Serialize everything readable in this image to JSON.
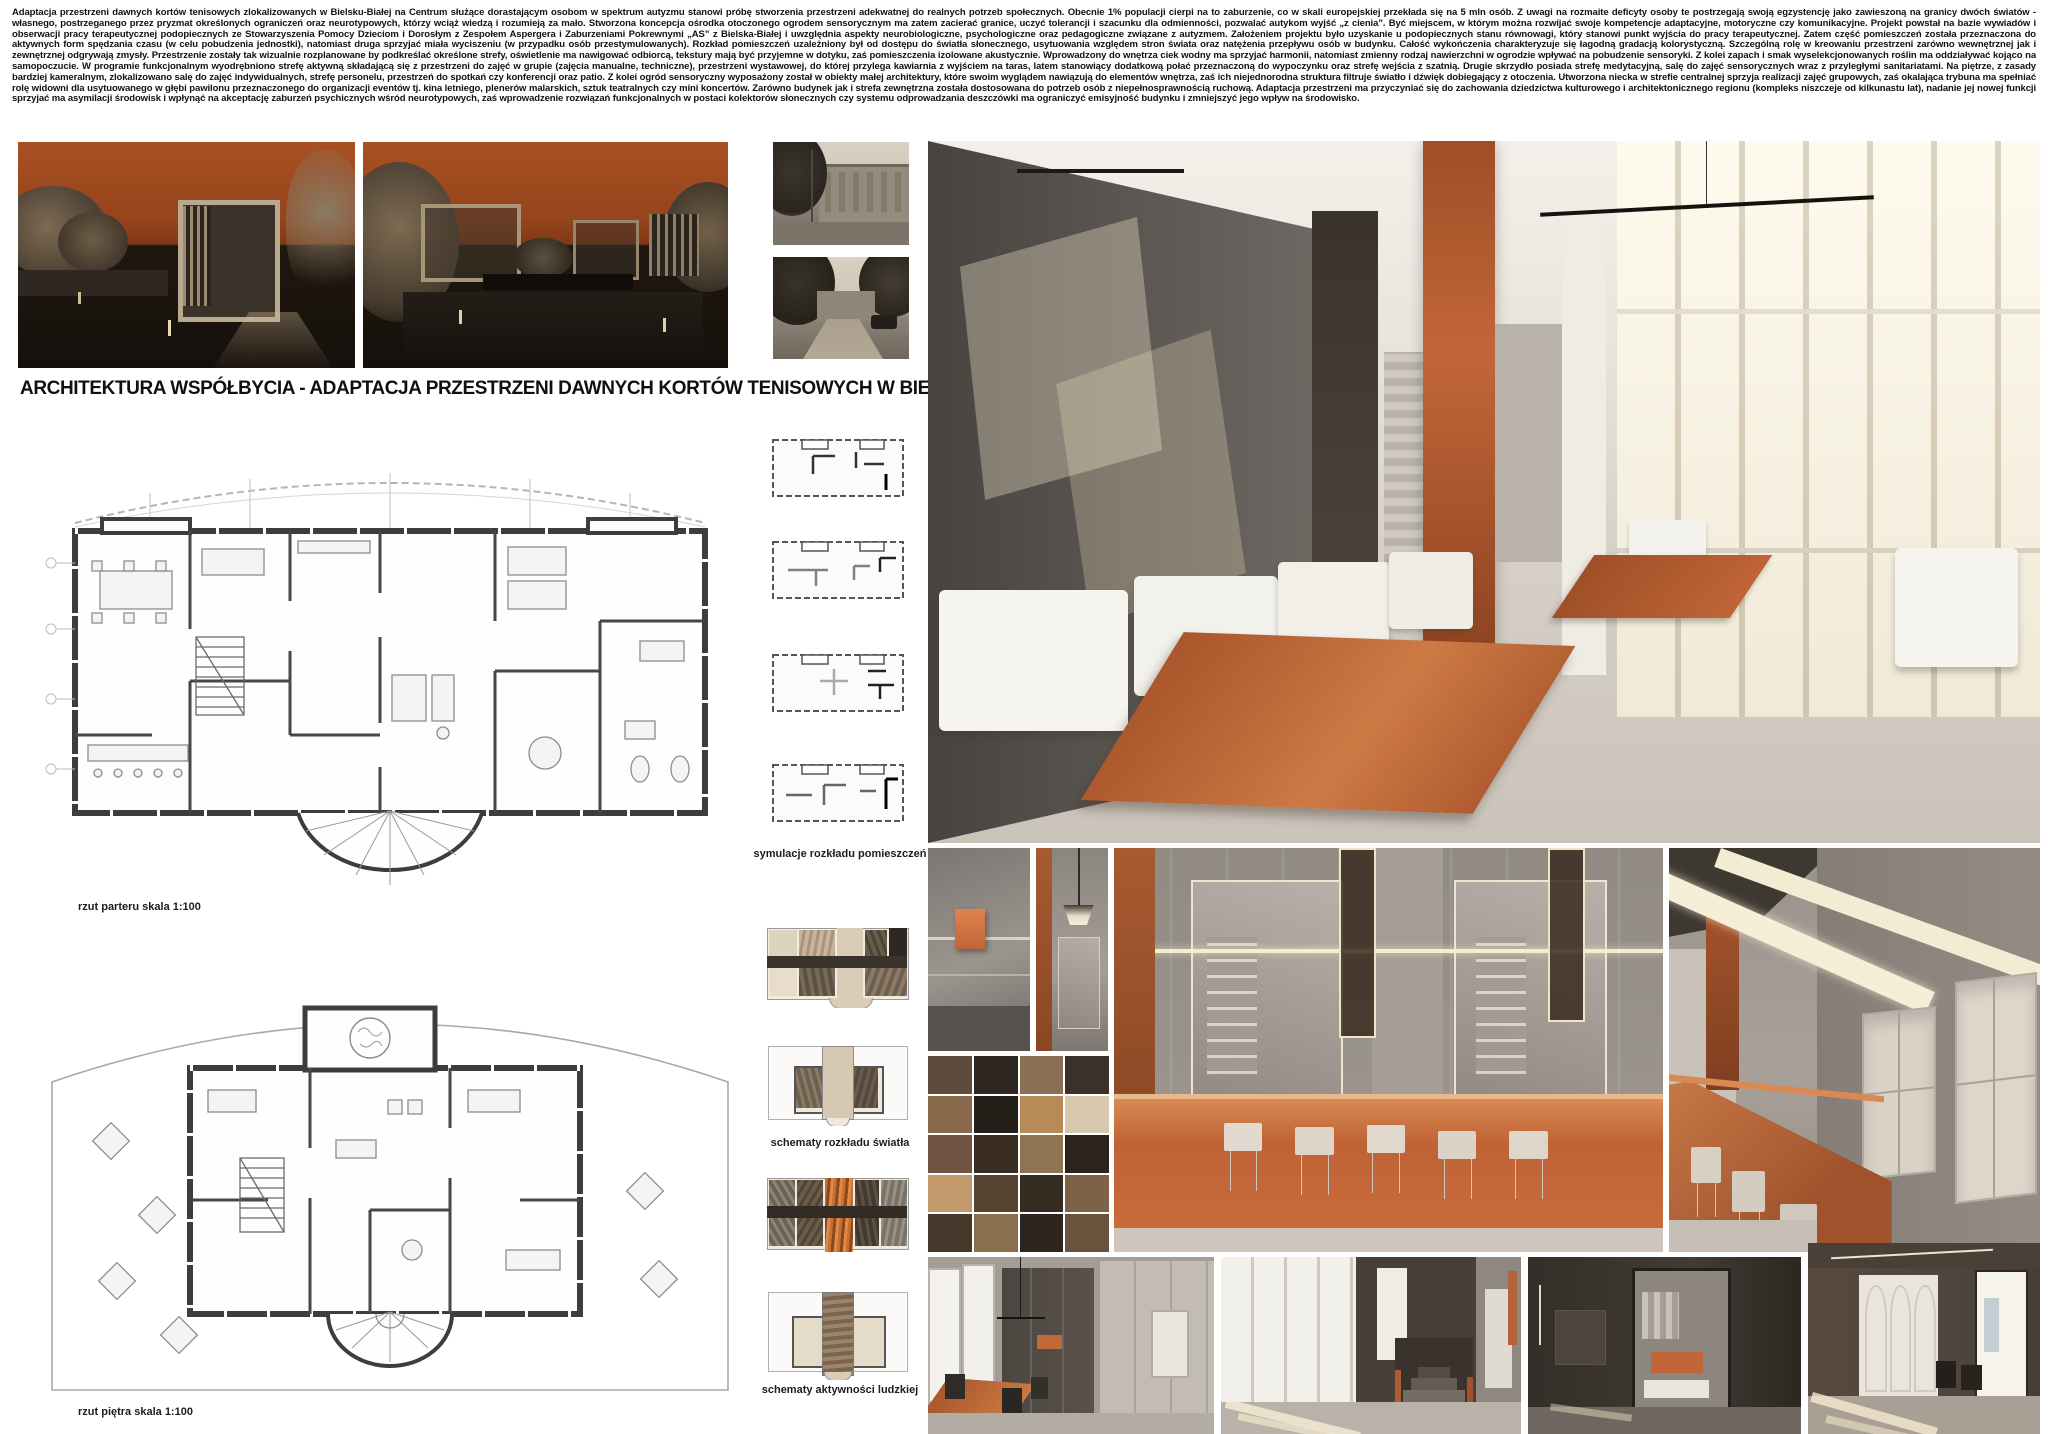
{
  "header": {
    "intro": "Adaptacja przestrzeni dawnych kortów tenisowych zlokalizowanych w Bielsku-Białej na Centrum służące dorastającym osobom w spektrum autyzmu stanowi próbę stworzenia przestrzeni adekwatnej do realnych potrzeb społecznych. Obecnie 1% populacji cierpi na to zaburzenie, co w skali europejskiej przekłada się na 5 mln osób. Z uwagi na rozmaite deficyty osoby te postrzegają swoją egzystencję jako zawieszoną na granicy dwóch światów - własnego, postrzeganego przez pryzmat określonych ograniczeń oraz neurotypowych, którzy wciąż wiedzą i rozumieją za mało. Stworzona koncepcja ośrodka otoczonego ogrodem sensorycznym ma zatem zacierać granice, uczyć tolerancji i szacunku dla odmienności, pozwalać autykom wyjść „z cienia”. Być miejscem, w którym można rozwijać swoje kompetencje adaptacyjne, motoryczne czy komunikacyjne. Projekt powstał na bazie wywiadów i obserwacji pracy terapeutycznej podopiecznych ze Stowarzyszenia Pomocy Dzieciom i Dorosłym z Zespołem Aspergera i Zaburzeniami Pokrewnymi „AS” z Bielska-Białej i uwzględnia aspekty neurobiologiczne, psychologiczne oraz pedagogiczne związane z autyzmem. Założeniem projektu było uzyskanie u podopiecznych stanu równowagi, który stanowi punkt wyjścia do pracy terapeutycznej. Zatem część pomieszczeń została przeznaczona do aktywnych form spędzania czasu (w celu pobudzenia jednostki), natomiast druga sprzyjać miała wyciszeniu (w przypadku osób przestymulowanych). Rozkład pomieszczeń uzależniony był od dostępu do światła słonecznego, usytuowania względem stron świata oraz natężenia przepływu osób w budynku. Całość wykończenia charakteryzuje się łagodną gradacją kolorystyczną. Szczególną rolę w kreowaniu przestrzeni zarówno wewnętrznej jak i zewnętrznej odgrywają zmysły. Przestrzenie zostały tak wizualnie rozplanowane by podkreślać określone strefy, oświetlenie ma nawigować odbiorcą, tekstury mają być przyjemne w dotyku, zaś pomieszczenia izolowane akustycznie. Wprowadzony do wnętrza ciek wodny ma sprzyjać harmonii, natomiast zmienny rodzaj nawierzchni w ogrodzie wpływać na pobudzenie sensoryki. Z kolei zapach i smak wyselekcjonowanych roślin ma oddziaływać kojąco na samopoczucie. W programie funkcjonalnym wyodrębniono strefę aktywną składającą się z przestrzeni do zajęć w grupie (zajęcia manualne, techniczne), przestrzeni wystawowej, do której przylega kawiarnia z wyjściem na taras, latem stanowiący dodatkową połać przeznaczoną do wypoczynku oraz strefę wejścia z szatnią. Drugie skrzydło posiada strefę medytacyjną, salę do zajęć sensorycznych wraz z przyległymi sanitariatami. Na piętrze, z zasady bardziej kameralnym, zlokalizowano salę do zajęć indywidualnych, strefę personelu, przestrzeń do spotkań czy konferencji oraz patio. Z kolei ogród sensoryczny wyposażony został w obiekty małej architektury, które swoim wyglądem nawiązują do elementów wnętrza, zaś ich niejednorodna struktura filtruje światło i dźwięk dobiegający z otoczenia. Utworzona niecka w strefie centralnej sprzyja realizacji zajęć grupowych, zaś okalająca trybuna ma spełniać rolę widowni dla usytuowanego w głębi pawilonu przeznaczonego do organizacji eventów tj. kina letniego, plenerów malarskich, sztuk teatralnych czy mini koncertów. Zarówno budynek jak i strefa zewnętrzna została dostosowana do potrzeb osób z niepełnosprawnością ruchową. Adaptacja przestrzeni ma przyczyniać się do zachowania dziedzictwa kulturowego i architektonicznego regionu (kompleks niszczeje od kilkunastu lat), nadanie jej nowej funkcji sprzyjać ma asymilacji środowisk i wpłynąć na akceptację zaburzeń psychicznych wśród neurotypowych, zaś wprowadzenie rozwiązań funkcjonalnych w postaci kolektorów słonecznych czy systemu odprowadzania deszczówki ma ograniczyć emisyjność budynku i zmniejszyć jego wpływ na środowisko."
  },
  "title": "ARCHITEKTURA WSPÓŁBYCIA - ADAPTACJA PRZESTRZENI DAWNYCH KORTÓW TENISOWYCH W BIELSKU - BIAŁEJ",
  "plans": {
    "ground_caption": "rzut parteru skala 1:100",
    "first_caption": "rzut piętra skala 1:100"
  },
  "diagrams": {
    "rooms_caption": "symulacje rozkładu pomieszczeń",
    "light_caption": "schematy rozkładu światła",
    "activity_caption": "schematy aktywności ludzkiej"
  },
  "palette": {
    "sky_orange": "#a85022",
    "accent_orange": "#c06537",
    "panel_orange": "#b05c31",
    "wall_gray": "#8d8781",
    "dark_wall": "#473f38",
    "paper": "#ffffff",
    "ink": "#141414"
  }
}
